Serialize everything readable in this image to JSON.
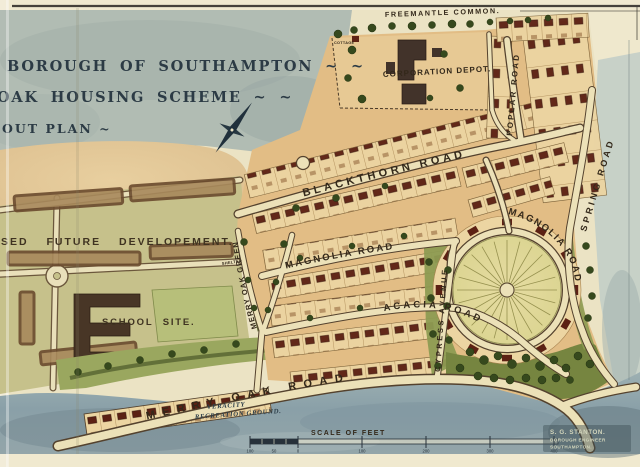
{
  "page": {
    "description": "Hand-drawn watercolour layout plan, Merry Oak housing estate, Southampton"
  },
  "title_block": {
    "line1": "BOROUGH OF SOUTHAMPTON ~ ~",
    "line2": "OAK HOUSING SCHEME ~ ~",
    "line3": "OUT PLAN ~"
  },
  "area_labels": {
    "freemantle_common": "FREEMANTLE COMMON.",
    "corporation_depot": "CORPORATION DEPOT.",
    "cottage": "COTTAGE",
    "shelter": "SHELTER",
    "future_development": "SED FUTURE DEVELOPEMENT.",
    "school_site": "SCHOOL SITE.",
    "recreation_line1": "VERACITY",
    "recreation_line2": "RECREATION GROUND."
  },
  "road_labels": {
    "blackthorn": "BLACKTHORN ROAD",
    "poplar": "POPLAR ROAD",
    "spring": "SPRING ROAD",
    "magnolia_west": "MAGNOLIA ROAD",
    "magnolia_east": "MAGNOLIA ROAD",
    "acacia": "ACACIA ROAD",
    "cypress": "CYPRESS AVENUE",
    "merry_oak_green": "MERRY OAK GREEN",
    "merry_oak_road": "MERRY OAK ROAD"
  },
  "scale_bar": {
    "title": "SCALE OF FEET",
    "ticks": [
      "100",
      "50",
      "0",
      "100",
      "200",
      "300",
      "400"
    ]
  },
  "signature": {
    "line1": "S. G. STANTON.",
    "line2": "BOROUGH ENGINEER",
    "line3": "SOUTHAMPTON."
  },
  "colors": {
    "paper": "#ebe3c4",
    "wash_blue": "#aeb9b2",
    "estate_tan": "#e2bd85",
    "plot_strip": "#ecd5a2",
    "roof_red": "#5c2114",
    "road_cream": "#ece1b8",
    "road_casing": "#54422e",
    "green_area": "#8b9852",
    "tree_green": "#36491d",
    "title_ink": "#2c3b45",
    "label_ink": "#33281a"
  }
}
